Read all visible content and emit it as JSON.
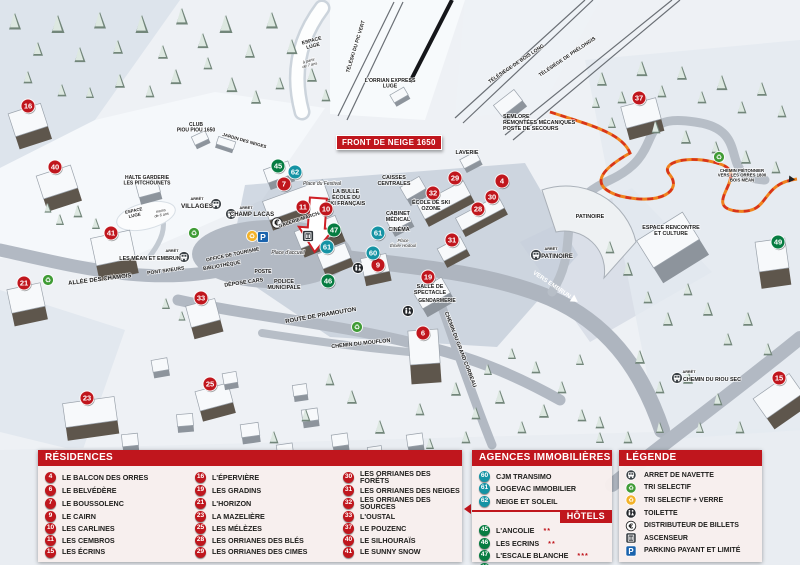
{
  "colors": {
    "residence": "#c0161d",
    "agence": "#1593a4",
    "hotel": "#067c41",
    "header": "#c0161d"
  },
  "banner": {
    "text": "FRONT DE NEIGE 1650"
  },
  "map": {
    "markers": [
      {
        "n": "16",
        "type": "residence",
        "x": 28,
        "y": 106
      },
      {
        "n": "40",
        "type": "residence",
        "x": 55,
        "y": 167
      },
      {
        "n": "41",
        "type": "residence",
        "x": 111,
        "y": 233
      },
      {
        "n": "21",
        "type": "residence",
        "x": 24,
        "y": 283
      },
      {
        "n": "23",
        "type": "residence",
        "x": 87,
        "y": 398
      },
      {
        "n": "33",
        "type": "residence",
        "x": 201,
        "y": 298
      },
      {
        "n": "25",
        "type": "residence",
        "x": 210,
        "y": 384
      },
      {
        "n": "7",
        "type": "residence",
        "x": 284,
        "y": 184
      },
      {
        "n": "11",
        "type": "residence",
        "x": 303,
        "y": 207
      },
      {
        "n": "10",
        "type": "residence",
        "x": 326,
        "y": 209
      },
      {
        "n": "9",
        "type": "residence",
        "x": 378,
        "y": 265
      },
      {
        "n": "6",
        "type": "residence",
        "x": 423,
        "y": 333
      },
      {
        "n": "19",
        "type": "residence",
        "x": 428,
        "y": 277
      },
      {
        "n": "31",
        "type": "residence",
        "x": 452,
        "y": 240
      },
      {
        "n": "32",
        "type": "residence",
        "x": 433,
        "y": 193
      },
      {
        "n": "29",
        "type": "residence",
        "x": 455,
        "y": 178
      },
      {
        "n": "4",
        "type": "residence",
        "x": 502,
        "y": 181
      },
      {
        "n": "30",
        "type": "residence",
        "x": 492,
        "y": 197
      },
      {
        "n": "28",
        "type": "residence",
        "x": 478,
        "y": 209
      },
      {
        "n": "37",
        "type": "residence",
        "x": 639,
        "y": 98
      },
      {
        "n": "15",
        "type": "residence",
        "x": 779,
        "y": 378
      },
      {
        "n": "62",
        "type": "agence",
        "x": 295,
        "y": 172
      },
      {
        "n": "61",
        "type": "agence",
        "x": 378,
        "y": 233
      },
      {
        "n": "60",
        "type": "agence",
        "x": 373,
        "y": 253
      },
      {
        "n": "61",
        "type": "agence",
        "x": 327,
        "y": 247
      },
      {
        "n": "45",
        "type": "hotel",
        "x": 278,
        "y": 166
      },
      {
        "n": "47",
        "type": "hotel",
        "x": 334,
        "y": 230
      },
      {
        "n": "46",
        "type": "hotel",
        "x": 328,
        "y": 281
      },
      {
        "n": "49",
        "type": "hotel",
        "x": 778,
        "y": 242
      }
    ],
    "labels": [
      {
        "t": "CLUB\nPIOU PIOU 1650",
        "x": 196,
        "y": 126,
        "s": 5,
        "r": 0,
        "st": "b"
      },
      {
        "t": "JARDIN DES NEIGES",
        "x": 244,
        "y": 142,
        "s": 4.5,
        "r": 16,
        "st": "b"
      },
      {
        "t": "HALTE GARDERIE\nLES PITCHOUNETS",
        "x": 147,
        "y": 179,
        "s": 5,
        "r": 0,
        "st": "b"
      },
      {
        "t": "ESPACE\nLUGE",
        "x": 312,
        "y": 42,
        "s": 5,
        "r": -15,
        "st": "b"
      },
      {
        "t": "à partir\nde 7 ans",
        "x": 309,
        "y": 62,
        "s": 4,
        "r": -15,
        "st": "i"
      },
      {
        "t": "TÉLÉSKI DU PIC VERT",
        "x": 357,
        "y": 47,
        "s": 5,
        "r": -73,
        "st": "b"
      },
      {
        "t": "L'ORRIAN EXPRESS\nLUGE",
        "x": 390,
        "y": 82,
        "s": 5.2,
        "r": 0,
        "st": "b"
      },
      {
        "t": "TÉLÉSIÈGE DE BOIS LONG",
        "x": 517,
        "y": 65,
        "s": 5,
        "r": -34,
        "st": "b"
      },
      {
        "t": "TÉLÉSIÈGE DE PRÉLONGIS",
        "x": 568,
        "y": 58,
        "s": 5,
        "r": -34,
        "st": "b"
      },
      {
        "t": "SEMLORE\nREMONTÉES MÉCANIQUES\nPOSTE DE SECOURS",
        "x": 503,
        "y": 118,
        "s": 5.4,
        "r": 0,
        "st": "b",
        "a": "start"
      },
      {
        "t": "LAVERIE",
        "x": 467,
        "y": 154,
        "s": 5.4,
        "r": 0,
        "st": "b"
      },
      {
        "t": "CAISSES\nCENTRALES",
        "x": 394,
        "y": 179,
        "s": 5.4,
        "r": 0,
        "st": "b"
      },
      {
        "t": "ÉCOLE DE SKI\nOZONE",
        "x": 431,
        "y": 204,
        "s": 5.4,
        "r": 0,
        "st": "b"
      },
      {
        "t": "LA BULLE\nÉCOLE DU\nSKI FRANÇAIS",
        "x": 346,
        "y": 193,
        "s": 5.4,
        "r": 0,
        "st": "b"
      },
      {
        "t": "Place du Festival",
        "x": 322,
        "y": 185,
        "s": 5,
        "r": 0,
        "st": "i"
      },
      {
        "t": "GALERIE MARCHANDE",
        "x": 306,
        "y": 219,
        "s": 5,
        "r": -18,
        "st": "b"
      },
      {
        "t": "ARRÊT",
        "x": 246,
        "y": 209,
        "s": 3.8,
        "r": 0,
        "st": "b"
      },
      {
        "t": "CHAMP LACAS",
        "x": 252,
        "y": 216,
        "s": 6,
        "r": 0,
        "st": "b"
      },
      {
        "t": "ARRÊT",
        "x": 197,
        "y": 200,
        "s": 3.8,
        "r": 0,
        "st": "b"
      },
      {
        "t": "VILLAGES",
        "x": 197,
        "y": 208,
        "s": 6.4,
        "r": 0,
        "st": "b"
      },
      {
        "t": "ARRÊT",
        "x": 172,
        "y": 252,
        "s": 3.8,
        "r": 0,
        "st": "b"
      },
      {
        "t": "LES MÉAN ET EMBRUN",
        "x": 150,
        "y": 260,
        "s": 5.4,
        "r": 0,
        "st": "b"
      },
      {
        "t": "PONT SKIEURS",
        "x": 166,
        "y": 272,
        "s": 5,
        "r": -8,
        "st": "b"
      },
      {
        "t": "ALLÉE DES CHAMOIS",
        "x": 100,
        "y": 281,
        "s": 6,
        "r": -7,
        "st": "b"
      },
      {
        "t": "BIBLIOTHÈQUE",
        "x": 222,
        "y": 267,
        "s": 5,
        "r": -10,
        "st": "b"
      },
      {
        "t": "OFFICE DE TOURISME",
        "x": 233,
        "y": 256,
        "s": 5,
        "r": -12,
        "st": "b"
      },
      {
        "t": "POSTE",
        "x": 263,
        "y": 273,
        "s": 5,
        "r": 0,
        "st": "b"
      },
      {
        "t": "DÉPOSE CARS",
        "x": 244,
        "y": 284,
        "s": 5.4,
        "r": -8,
        "st": "b"
      },
      {
        "t": "POLICE\nMUNICIPALE",
        "x": 284,
        "y": 283,
        "s": 5.4,
        "r": 0,
        "st": "b"
      },
      {
        "t": "Place d'accueil",
        "x": 288,
        "y": 254,
        "s": 5,
        "r": 0,
        "st": "i"
      },
      {
        "t": "CABINET\nMÉDICAL",
        "x": 398,
        "y": 215,
        "s": 5.4,
        "r": 0,
        "st": "b"
      },
      {
        "t": "CINÉMA",
        "x": 399,
        "y": 231,
        "s": 5.4,
        "r": 0,
        "st": "b"
      },
      {
        "t": "Place\nÉmile Hodoul",
        "x": 403,
        "y": 242,
        "s": 4.4,
        "r": 0,
        "st": "i"
      },
      {
        "t": "SALLE DE\nSPECTACLE",
        "x": 430,
        "y": 288,
        "s": 5.4,
        "r": 0,
        "st": "b"
      },
      {
        "t": "GENDARMERIE",
        "x": 437,
        "y": 302,
        "s": 5,
        "r": 0,
        "st": "b"
      },
      {
        "t": "ROUTE DE PRAMOUTON",
        "x": 321,
        "y": 317,
        "s": 6,
        "r": -10,
        "st": "b"
      },
      {
        "t": "CHEMIN DU MOUFLON",
        "x": 361,
        "y": 345,
        "s": 5.4,
        "r": -6,
        "st": "b"
      },
      {
        "t": "CHEMIN DU GRAND CORBEAU",
        "x": 459,
        "y": 350,
        "s": 5.4,
        "r": 69,
        "st": "b"
      },
      {
        "t": "ARRÊT",
        "x": 551,
        "y": 250,
        "s": 3.8,
        "r": 0,
        "st": "b"
      },
      {
        "t": "PATINOIRE",
        "x": 557,
        "y": 258,
        "s": 6,
        "r": 0,
        "st": "b"
      },
      {
        "t": "PATINOIRE",
        "x": 590,
        "y": 218,
        "s": 5.4,
        "r": 0,
        "st": "b"
      },
      {
        "t": "ESPACE RENCONTRE\nET CULTURE",
        "x": 671,
        "y": 229,
        "s": 5.4,
        "r": 0,
        "st": "b"
      },
      {
        "t": "VERS EMBRUN",
        "x": 551,
        "y": 286,
        "s": 6,
        "r": 34,
        "st": "w"
      },
      {
        "t": "CHEMIN PIÉTONNIER\nVERS LES ORRES 1800\nBOIS MÉAN",
        "x": 742,
        "y": 172,
        "s": 4.3,
        "r": 0,
        "st": "b"
      },
      {
        "t": "ARRÊT",
        "x": 689,
        "y": 373,
        "s": 3.8,
        "r": 0,
        "st": "b"
      },
      {
        "t": "CHEMIN DU RIOU SEC",
        "x": 712,
        "y": 381,
        "s": 5.4,
        "r": 0,
        "st": "b"
      },
      {
        "t": "ESPACE\nLUGE",
        "x": 134,
        "y": 212,
        "s": 4.4,
        "r": -12,
        "st": "b"
      },
      {
        "t": "moins\nde 6 ans",
        "x": 161,
        "y": 212,
        "s": 3.8,
        "r": -12,
        "st": "i"
      }
    ],
    "icons": [
      {
        "kind": "bus",
        "x": 216,
        "y": 204
      },
      {
        "kind": "bus",
        "x": 231,
        "y": 214
      },
      {
        "kind": "bus",
        "x": 184,
        "y": 257
      },
      {
        "kind": "bus",
        "x": 536,
        "y": 255
      },
      {
        "kind": "bus",
        "x": 677,
        "y": 378
      },
      {
        "kind": "recycle",
        "x": 194,
        "y": 233
      },
      {
        "kind": "recycle",
        "x": 48,
        "y": 280
      },
      {
        "kind": "recycle",
        "x": 357,
        "y": 327
      },
      {
        "kind": "recycle",
        "x": 719,
        "y": 157
      },
      {
        "kind": "recycle-verre",
        "x": 252,
        "y": 236
      },
      {
        "kind": "parking",
        "x": 263,
        "y": 237
      },
      {
        "kind": "euro",
        "x": 277,
        "y": 223
      },
      {
        "kind": "ascenseur",
        "x": 308,
        "y": 236
      },
      {
        "kind": "toilette",
        "x": 358,
        "y": 268
      },
      {
        "kind": "toilette",
        "x": 408,
        "y": 311
      },
      {
        "kind": "white-arrow",
        "x": 572,
        "y": 298,
        "rot": 34
      },
      {
        "kind": "trail-arrow",
        "x": 789,
        "y": 179,
        "rot": 5
      }
    ]
  },
  "panels": {
    "residences": {
      "title": "RÉSIDENCES",
      "items": [
        {
          "n": "4",
          "label": "LE BALCON DES ORRES"
        },
        {
          "n": "6",
          "label": "LE BELVÉDÈRE"
        },
        {
          "n": "7",
          "label": "LE BOUSSOLENC"
        },
        {
          "n": "9",
          "label": "LE CAIRN"
        },
        {
          "n": "10",
          "label": "LES CARLINES"
        },
        {
          "n": "11",
          "label": "LES CEMBROS"
        },
        {
          "n": "15",
          "label": "LES ÉCRINS"
        },
        {
          "n": "16",
          "label": "L'ÉPERVIÈRE"
        },
        {
          "n": "19",
          "label": "LES GRADINS"
        },
        {
          "n": "21",
          "label": "L'HORIZON"
        },
        {
          "n": "23",
          "label": "LA MAZELIÈRE"
        },
        {
          "n": "25",
          "label": "LES MÉLÈZES"
        },
        {
          "n": "28",
          "label": "LES ORRIANES DES BLÉS"
        },
        {
          "n": "29",
          "label": "LES ORRIANES DES CIMES"
        },
        {
          "n": "30",
          "label": "LES ORRIANES DES FORÊTS"
        },
        {
          "n": "31",
          "label": "LES ORRIANES DES NEIGES"
        },
        {
          "n": "32",
          "label": "LES ORRIANES DES SOURCES"
        },
        {
          "n": "33",
          "label": "L'OUSTAL"
        },
        {
          "n": "37",
          "label": "LE POUZENC"
        },
        {
          "n": "40",
          "label": "LE SILHOURAÏS"
        },
        {
          "n": "41",
          "label": "LE SUNNY SNOW"
        }
      ]
    },
    "agences": {
      "title": "AGENCES IMMOBILIÈRES",
      "items": [
        {
          "n": "60",
          "label": "CJM TRANSIMO"
        },
        {
          "n": "61",
          "label": "LOGEVAC IMMOBILIER"
        },
        {
          "n": "62",
          "label": "NEIGE ET SOLEIL"
        }
      ]
    },
    "hotels": {
      "title": "HÔTELS",
      "items": [
        {
          "n": "45",
          "label": "L'ANCOLIE",
          "stars": "**"
        },
        {
          "n": "46",
          "label": "LES ECRINS",
          "stars": "**"
        },
        {
          "n": "47",
          "label": "L'ESCALE BLANCHE",
          "stars": "***"
        },
        {
          "n": "49",
          "label": "LES TRAPPEURS",
          "stars": "**"
        }
      ]
    },
    "legende": {
      "title": "LÉGENDE",
      "items": [
        {
          "icon": "bus",
          "label": "ARRET DE NAVETTE"
        },
        {
          "icon": "recycle",
          "label": "TRI SELECTIF"
        },
        {
          "icon": "recycle-verre",
          "label": "TRI SELECTIF + VERRE"
        },
        {
          "icon": "toilette",
          "label": "TOILETTE"
        },
        {
          "icon": "euro",
          "label": "DISTRIBUTEUR DE BILLETS"
        },
        {
          "icon": "ascenseur",
          "label": "ASCENSEUR"
        },
        {
          "icon": "parking",
          "label": "PARKING PAYANT ET LIMITÉ"
        }
      ]
    }
  }
}
